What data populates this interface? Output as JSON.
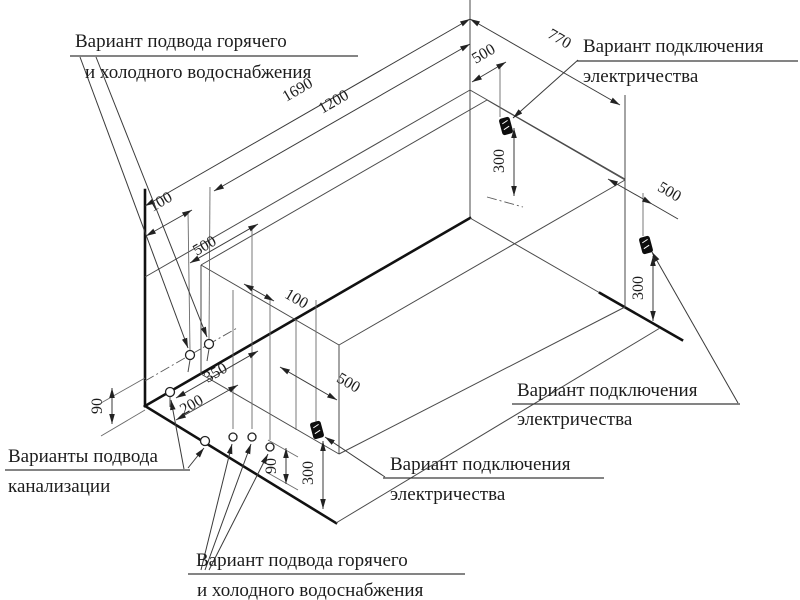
{
  "diagram": {
    "labels": {
      "water_supply_top": [
        "Вариант подвода горячего",
        "и холодного водоснабжения"
      ],
      "electric_top": [
        "Вариант подключения",
        "электричества"
      ],
      "electric_right": [
        "Вариант подключения",
        "электричества"
      ],
      "electric_bottom": [
        "Вариант подключения",
        "электричества"
      ],
      "sewer": [
        "Варианты подвода",
        "канализации"
      ],
      "water_supply_bottom": [
        "Вариант подвода горячего",
        "и холодного водоснабжения"
      ]
    },
    "dims": {
      "length_total": "1690",
      "length_partial": "1200",
      "width_total": "770",
      "offset_100_top": "100",
      "wall_500": "500",
      "offset_100_mid": "100",
      "floor_350": "350",
      "floor_200": "200",
      "floor_500": "500",
      "height_90_left": "90",
      "height_90_bottom": "90",
      "height_300_bottom": "300",
      "back_500": "500",
      "back_300": "300",
      "right_500": "500",
      "right_300": "300"
    },
    "symbols": {
      "outlet": "electrical-outlet",
      "pipe_point": "pipe-connection-point"
    },
    "colors": {
      "background": "#ffffff",
      "thin_line": "#4a4a4a",
      "thick_line": "#111111",
      "text": "#1c1c1c"
    }
  }
}
